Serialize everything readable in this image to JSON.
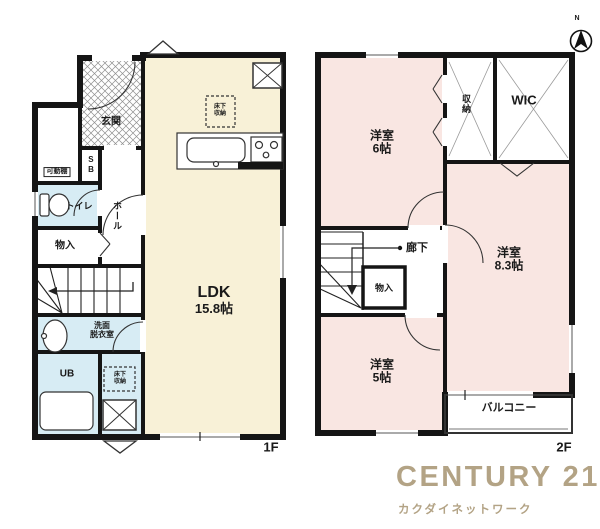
{
  "colors": {
    "wall": "#151515",
    "ldk_cream": "#f8f1d7",
    "bedroom_pink": "#f9e6e2",
    "wet_blue": "#d7ecf4",
    "logo_gold": "#b3a385"
  },
  "compass": {
    "label": "N"
  },
  "floor1": {
    "floor_label": "1F",
    "ldk": {
      "line1": "LDK",
      "line2": "15.8帖"
    },
    "genkan": "玄関",
    "kadodana": "可動棚",
    "sb": "SB",
    "toilet": "トイレ",
    "hall": "ホール",
    "monoire": "物入",
    "senmen": {
      "line1": "洗面",
      "line2": "脱衣室"
    },
    "ub": "UB",
    "yukashita": {
      "line1": "床下",
      "line2": "収納"
    }
  },
  "floor2": {
    "floor_label": "2F",
    "room6": {
      "line1": "洋室",
      "line2": "6帖"
    },
    "shuno": "収納",
    "wic": "WIC",
    "rouka": "廊下",
    "monoire": "物入",
    "room83": {
      "line1": "洋室",
      "line2": "8.3帖"
    },
    "room5": {
      "line1": "洋室",
      "line2": "5帖"
    },
    "balcony": "バルコニー"
  },
  "logo": {
    "brand": "CENTURY 21",
    "company": "カクダイネットワーク"
  }
}
